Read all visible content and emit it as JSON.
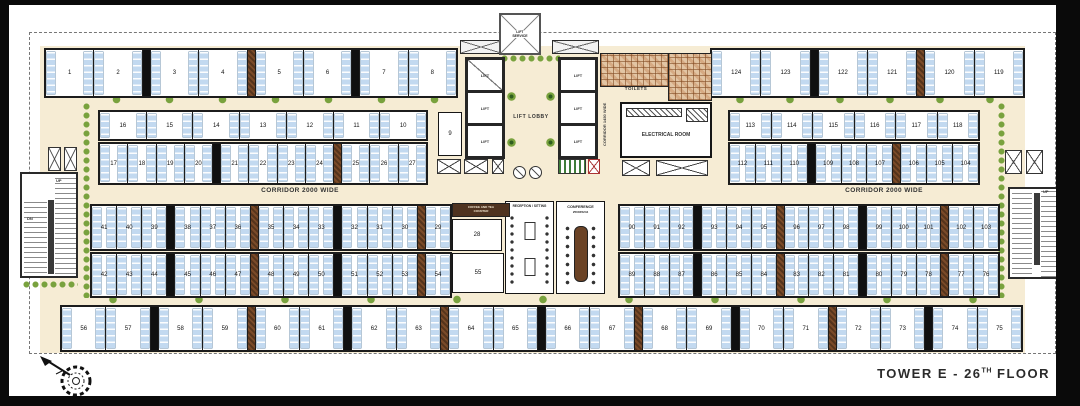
{
  "title": {
    "text": "TOWER E - 26TH FLOOR",
    "main": "TOWER E - 26",
    "sup": "TH",
    "tail": " FLOOR"
  },
  "labels": {
    "corridor_left": "CORRIDOR 2000 WIDE",
    "corridor_right": "CORRIDOR 2000 WIDE",
    "corridor_center": "CORRIDOR 1450 WIDE",
    "lift_lobby": "LIFT LOBBY",
    "lift": "LIFT",
    "service_lift_1": "LIFT",
    "service_lift_2": "SERVICE",
    "toilets": "TOILETS",
    "electrical_room": "ELECTRICAL ROOM",
    "reception": "RECEPTION / SITTING",
    "conference_name": "CONFERENCE",
    "conference_size": "2500X5244",
    "coffee_1": "COFFEE AND TEA",
    "coffee_2": "COUNTER",
    "up": "UP",
    "dn": "DN"
  },
  "units": {
    "top_left": [
      "1",
      "2",
      "3",
      "4",
      "5",
      "6",
      "7",
      "8"
    ],
    "top_right": [
      "124",
      "123",
      "122",
      "121",
      "120",
      "119"
    ],
    "band2_left_top": [
      "16",
      "15",
      "14",
      "13",
      "12",
      "11",
      "10"
    ],
    "band2_left_bottom": [
      "17",
      "18",
      "19",
      "20",
      "21",
      "22",
      "23",
      "24",
      "25",
      "26",
      "27"
    ],
    "band2_right_top": [
      "113",
      "114",
      "115",
      "116",
      "117",
      "118"
    ],
    "band2_right_bottom": [
      "112",
      "111",
      "110",
      "109",
      "108",
      "107",
      "106",
      "105",
      "104"
    ],
    "mid_left_top": [
      "41",
      "40",
      "39",
      "38",
      "37",
      "36",
      "35",
      "34",
      "33",
      "32",
      "31",
      "30",
      "29"
    ],
    "mid_left_bottom": [
      "42",
      "43",
      "44",
      "45",
      "46",
      "47",
      "48",
      "49",
      "50",
      "51",
      "52",
      "53",
      "54"
    ],
    "mid_right_top": [
      "90",
      "91",
      "92",
      "93",
      "94",
      "95",
      "96",
      "97",
      "98",
      "99",
      "100",
      "101",
      "102",
      "103"
    ],
    "mid_right_bottom": [
      "89",
      "88",
      "87",
      "86",
      "85",
      "84",
      "83",
      "82",
      "81",
      "80",
      "79",
      "78",
      "77",
      "76"
    ],
    "bottom": [
      "56",
      "57",
      "58",
      "59",
      "60",
      "61",
      "62",
      "63",
      "64",
      "65",
      "66",
      "67",
      "68",
      "69",
      "70",
      "71",
      "72",
      "73",
      "74",
      "75"
    ],
    "unit9": "9",
    "unit28": "28",
    "unit55": "55"
  },
  "colors": {
    "cream": "#f6ecd4",
    "unitBlue": "#c2d9f0",
    "wall": "#1c1c1c",
    "planter": "#7a4a28",
    "hedge": "#79a23e",
    "counter": "#4f3320",
    "tableBrown": "#6b4326",
    "tile": "#e2c5a4",
    "frame": "#0a0a0a"
  }
}
